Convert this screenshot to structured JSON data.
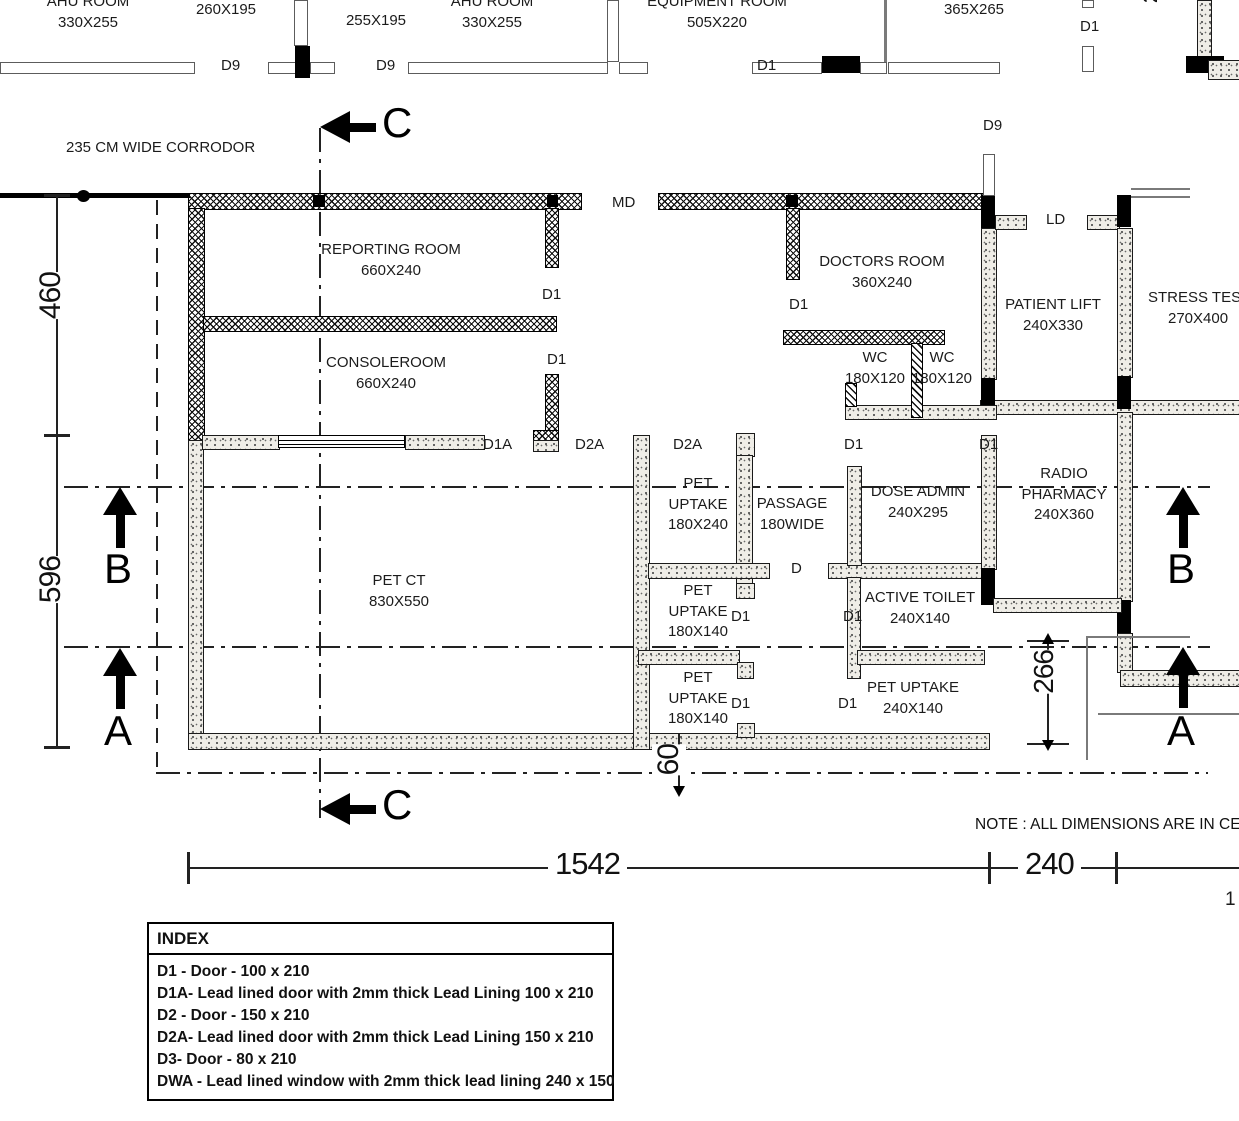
{
  "plan": {
    "corridor_label": "235 CM WIDE CORRODOR",
    "note": "NOTE : ALL DIMENSIONS ARE IN CENTIMETERS",
    "partial_dim_top": "2",
    "partial_dim_bottom": "1"
  },
  "rooms": {
    "ahu_left": {
      "name": "AHU ROOM",
      "dims": "330X255"
    },
    "store_260": {
      "dims": "260X195"
    },
    "store_255": {
      "dims": "255X195"
    },
    "ahu_right": {
      "name": "AHU ROOM",
      "dims": "330X255"
    },
    "equipment": {
      "name": "EQUIPMENT ROOM",
      "dims": "505X220"
    },
    "room_365": {
      "dims": "365X265"
    },
    "reporting": {
      "name": "REPORTING ROOM",
      "dims": "660X240"
    },
    "console": {
      "name": "CONSOLEROOM",
      "dims": "660X240"
    },
    "doctors": {
      "name": "DOCTORS ROOM",
      "dims": "360X240"
    },
    "patient_lift": {
      "name": "PATIENT LIFT",
      "dims": "240X330"
    },
    "stress_test": {
      "name": "STRESS TEST",
      "dims": "270X400"
    },
    "wc_left": {
      "name": "WC",
      "dims": "180X120"
    },
    "wc_right": {
      "name": "WC",
      "dims": "180X120"
    },
    "pet_ct": {
      "name": "PET CT",
      "dims": "830X550"
    },
    "pet_uptake_top": {
      "line1": "PET",
      "line2": "UPTAKE",
      "dims": "180X240"
    },
    "passage": {
      "line1": "PASSAGE",
      "line2": "180WIDE"
    },
    "dose_admin": {
      "name": "DOSE ADMIN",
      "dims": "240X295"
    },
    "active_toilet": {
      "name": "ACTIVE TOILET",
      "dims": "240X140"
    },
    "pet_uptake_mid": {
      "line1": "PET",
      "line2": "UPTAKE",
      "dims": "180X140"
    },
    "pet_uptake_bottom": {
      "line1": "PET",
      "line2": "UPTAKE",
      "dims": "180X140"
    },
    "pet_uptake_right": {
      "name": "PET UPTAKE",
      "dims": "240X140"
    },
    "radio_pharmacy": {
      "line1": "RADIO",
      "line2": "PHARMACY",
      "dims": "240X360"
    }
  },
  "door_labels": {
    "d9": "D9",
    "d1": "D1",
    "d1a": "D1A",
    "d2a": "D2A",
    "d": "D",
    "md": "MD",
    "ld": "LD"
  },
  "dims": {
    "v460": "460",
    "v596": "596",
    "v266": "266",
    "v60": "60",
    "h1542": "1542",
    "h240": "240"
  },
  "sections": {
    "a": "A",
    "b": "B",
    "c": "C"
  },
  "index": {
    "title": "INDEX",
    "entries": [
      "D1 - Door  - 100 x 210",
      "D1A- Lead lined door with 2mm thick Lead Lining 100 x 210",
      "D2 - Door - 150 x 210",
      "D2A- Lead lined door with 2mm thick Lead Lining 150 x 210",
      "D3- Door - 80 x 210",
      "DWA - Lead lined window with 2mm thick lead lining 240 x 150"
    ]
  }
}
